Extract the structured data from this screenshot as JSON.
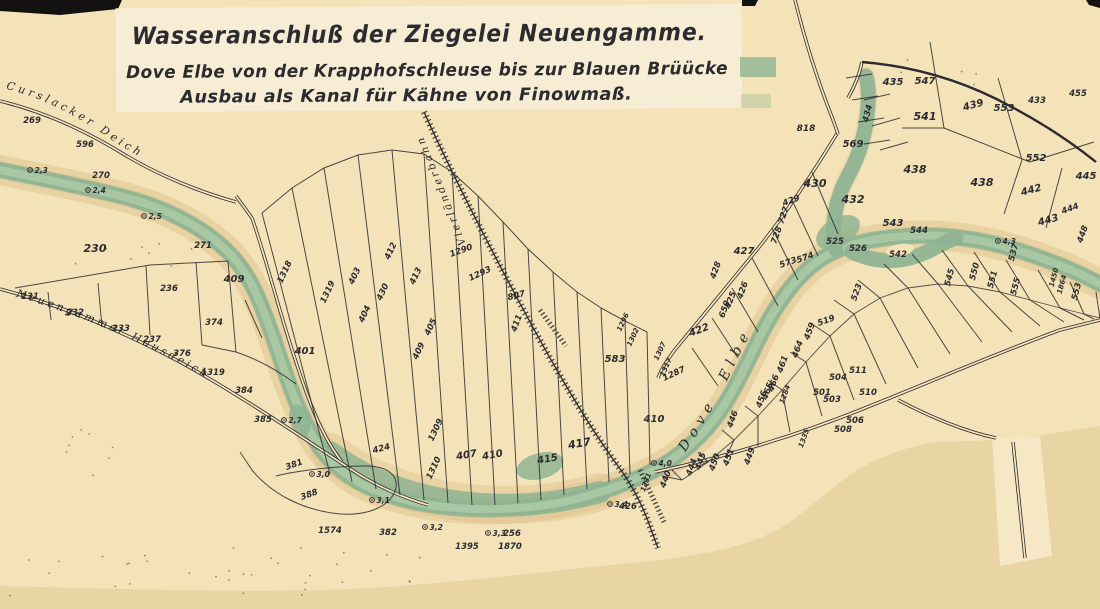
{
  "title_block": {
    "line1": "Wasseranschluß der Ziegelei Neuengamme.",
    "line2": "Dove Elbe von der Krapphofschleuse bis zur Blauen Brüücke",
    "line3": "Ausbau als Kanal für Kähne von Finowmaß."
  },
  "map": {
    "place_labels": {
      "curslacker": "Curslacker Deich",
      "hausdeich": "Neuengammer Hausdeich",
      "bahn": "Vierländerbahn",
      "dove": "Dove Elbe"
    },
    "colors": {
      "ink": "#2b2b30",
      "paper": "#f4e3b8",
      "paper_light": "#f7ecd4",
      "backing": "#e9d4a4",
      "water": "#8fb492",
      "water_light": "#abc9a4",
      "water_edge": "#6f9c7e",
      "bank": "#ddc28c",
      "wedge": "#e4cd9c",
      "blue_label": "#3f5680",
      "black_edge": "#141210"
    },
    "parcel_numbers": [
      {
        "t": "269",
        "x": 32,
        "y": 123
      },
      {
        "t": "596",
        "x": 85,
        "y": 147
      },
      {
        "t": "270",
        "x": 101,
        "y": 178
      },
      {
        "t": "230",
        "x": 95,
        "y": 252,
        "s": 11
      },
      {
        "t": "231",
        "x": 30,
        "y": 299
      },
      {
        "t": "232",
        "x": 75,
        "y": 315
      },
      {
        "t": "233",
        "x": 121,
        "y": 331
      },
      {
        "t": "236",
        "x": 169,
        "y": 291
      },
      {
        "t": "237",
        "x": 152,
        "y": 342
      },
      {
        "t": "271",
        "x": 203,
        "y": 248
      },
      {
        "t": "409",
        "x": 234,
        "y": 282,
        "s": 10
      },
      {
        "t": "374",
        "x": 214,
        "y": 325
      },
      {
        "t": "376",
        "x": 182,
        "y": 356
      },
      {
        "t": "1319",
        "x": 213,
        "y": 375
      },
      {
        "t": "384",
        "x": 244,
        "y": 393
      },
      {
        "t": "385",
        "x": 263,
        "y": 422
      },
      {
        "t": "381",
        "x": 295,
        "y": 467,
        "r": -20
      },
      {
        "t": "388",
        "x": 310,
        "y": 497,
        "r": -20
      },
      {
        "t": "1574",
        "x": 330,
        "y": 533
      },
      {
        "t": "382",
        "x": 388,
        "y": 535
      },
      {
        "t": "424",
        "x": 382,
        "y": 451,
        "r": -15
      },
      {
        "t": "401",
        "x": 305,
        "y": 354,
        "s": 10
      },
      {
        "t": "1318",
        "x": 287,
        "y": 273,
        "r": -65
      },
      {
        "t": "1319",
        "x": 330,
        "y": 293,
        "r": -65
      },
      {
        "t": "403",
        "x": 357,
        "y": 277,
        "r": -65
      },
      {
        "t": "430",
        "x": 385,
        "y": 293,
        "r": -65
      },
      {
        "t": "404",
        "x": 367,
        "y": 315,
        "r": -65
      },
      {
        "t": "412",
        "x": 393,
        "y": 252,
        "r": -65
      },
      {
        "t": "413",
        "x": 418,
        "y": 277,
        "r": -65
      },
      {
        "t": "405",
        "x": 433,
        "y": 328,
        "r": -65
      },
      {
        "t": "409",
        "x": 421,
        "y": 352,
        "r": -65
      },
      {
        "t": "1309",
        "x": 438,
        "y": 431,
        "r": -65
      },
      {
        "t": "1310",
        "x": 436,
        "y": 469,
        "r": -65
      },
      {
        "t": "407",
        "x": 467,
        "y": 458,
        "s": 10,
        "r": -10
      },
      {
        "t": "410",
        "x": 493,
        "y": 458,
        "s": 10,
        "r": -10
      },
      {
        "t": "415",
        "x": 548,
        "y": 462,
        "s": 10,
        "r": -10
      },
      {
        "t": "417",
        "x": 580,
        "y": 447,
        "s": 11,
        "r": -10
      },
      {
        "t": "1290",
        "x": 462,
        "y": 253,
        "r": -20
      },
      {
        "t": "1293",
        "x": 481,
        "y": 276,
        "r": -25
      },
      {
        "t": "807",
        "x": 517,
        "y": 298,
        "r": -15
      },
      {
        "t": "411",
        "x": 519,
        "y": 324,
        "r": -70
      },
      {
        "t": "583",
        "x": 615,
        "y": 362,
        "s": 10
      },
      {
        "t": "1296",
        "x": 625,
        "y": 323,
        "r": -65,
        "s": 7
      },
      {
        "t": "1302",
        "x": 635,
        "y": 338,
        "r": -65,
        "s": 7
      },
      {
        "t": "1307",
        "x": 662,
        "y": 352,
        "r": -65,
        "s": 7
      },
      {
        "t": "1317",
        "x": 668,
        "y": 368,
        "r": -65,
        "s": 7
      },
      {
        "t": "410",
        "x": 654,
        "y": 422,
        "s": 10
      },
      {
        "t": "426",
        "x": 628,
        "y": 509
      },
      {
        "t": "256",
        "x": 512,
        "y": 536
      },
      {
        "t": "1395",
        "x": 467,
        "y": 549
      },
      {
        "t": "1870",
        "x": 510,
        "y": 549
      },
      {
        "t": "818",
        "x": 806,
        "y": 131,
        "s": 9
      },
      {
        "t": "435",
        "x": 893,
        "y": 85,
        "s": 10
      },
      {
        "t": "547",
        "x": 925,
        "y": 84,
        "s": 10
      },
      {
        "t": "541",
        "x": 925,
        "y": 120,
        "s": 11
      },
      {
        "t": "434",
        "x": 870,
        "y": 114,
        "r": -75
      },
      {
        "t": "569",
        "x": 853,
        "y": 147,
        "s": 10
      },
      {
        "t": "430",
        "x": 815,
        "y": 187,
        "s": 11
      },
      {
        "t": "429",
        "x": 792,
        "y": 203,
        "r": -20
      },
      {
        "t": "727",
        "x": 786,
        "y": 216,
        "r": -70
      },
      {
        "t": "728",
        "x": 779,
        "y": 236,
        "r": -70
      },
      {
        "t": "428",
        "x": 718,
        "y": 271,
        "r": -70
      },
      {
        "t": "427",
        "x": 744,
        "y": 254,
        "s": 10
      },
      {
        "t": "432",
        "x": 853,
        "y": 203,
        "s": 11
      },
      {
        "t": "438",
        "x": 915,
        "y": 173,
        "s": 11
      },
      {
        "t": "543",
        "x": 893,
        "y": 226,
        "s": 10
      },
      {
        "t": "544",
        "x": 919,
        "y": 233
      },
      {
        "t": "525",
        "x": 835,
        "y": 244
      },
      {
        "t": "526",
        "x": 858,
        "y": 251
      },
      {
        "t": "573",
        "x": 789,
        "y": 265,
        "r": -20
      },
      {
        "t": "574",
        "x": 806,
        "y": 260,
        "r": -20
      },
      {
        "t": "542",
        "x": 898,
        "y": 257
      },
      {
        "t": "426",
        "x": 745,
        "y": 291,
        "r": -70
      },
      {
        "t": "425",
        "x": 733,
        "y": 301,
        "r": -70
      },
      {
        "t": "650",
        "x": 727,
        "y": 310,
        "r": -70
      },
      {
        "t": "422",
        "x": 700,
        "y": 333,
        "r": -20,
        "s": 10
      },
      {
        "t": "1287",
        "x": 675,
        "y": 376,
        "r": -25
      },
      {
        "t": "459",
        "x": 812,
        "y": 332,
        "r": -70
      },
      {
        "t": "464",
        "x": 800,
        "y": 350,
        "r": -70
      },
      {
        "t": "461",
        "x": 785,
        "y": 365,
        "r": -70
      },
      {
        "t": "466",
        "x": 776,
        "y": 384,
        "r": -70
      },
      {
        "t": "465",
        "x": 770,
        "y": 392,
        "r": -70
      },
      {
        "t": "456",
        "x": 764,
        "y": 400,
        "r": -70
      },
      {
        "t": "1284",
        "x": 787,
        "y": 395,
        "r": -70,
        "s": 7
      },
      {
        "t": "1335",
        "x": 806,
        "y": 439,
        "r": -70,
        "s": 7
      },
      {
        "t": "449",
        "x": 752,
        "y": 457,
        "r": -70
      },
      {
        "t": "451",
        "x": 731,
        "y": 458,
        "r": -70
      },
      {
        "t": "450",
        "x": 717,
        "y": 463,
        "r": -70
      },
      {
        "t": "445",
        "x": 703,
        "y": 462,
        "r": -70
      },
      {
        "t": "444",
        "x": 694,
        "y": 468,
        "r": -70
      },
      {
        "t": "440",
        "x": 668,
        "y": 480,
        "r": -70
      },
      {
        "t": "1331",
        "x": 648,
        "y": 483,
        "r": -70,
        "s": 7
      },
      {
        "t": "446",
        "x": 735,
        "y": 420,
        "r": -70
      },
      {
        "t": "501",
        "x": 822,
        "y": 395
      },
      {
        "t": "503",
        "x": 832,
        "y": 402
      },
      {
        "t": "504",
        "x": 838,
        "y": 380
      },
      {
        "t": "506",
        "x": 855,
        "y": 423
      },
      {
        "t": "508",
        "x": 843,
        "y": 432
      },
      {
        "t": "510",
        "x": 868,
        "y": 395
      },
      {
        "t": "511",
        "x": 858,
        "y": 373
      },
      {
        "t": "519",
        "x": 827,
        "y": 323,
        "r": -20
      },
      {
        "t": "523",
        "x": 859,
        "y": 293,
        "r": -70
      },
      {
        "t": "439",
        "x": 974,
        "y": 108,
        "s": 10,
        "r": -15
      },
      {
        "t": "553",
        "x": 1004,
        "y": 111,
        "s": 10
      },
      {
        "t": "552",
        "x": 1036,
        "y": 161,
        "s": 10
      },
      {
        "t": "445",
        "x": 1086,
        "y": 179,
        "s": 10
      },
      {
        "t": "438",
        "x": 982,
        "y": 186,
        "s": 11
      },
      {
        "t": "442",
        "x": 1032,
        "y": 193,
        "s": 10,
        "r": -15
      },
      {
        "t": "444",
        "x": 1071,
        "y": 211,
        "r": -20
      },
      {
        "t": "443",
        "x": 1049,
        "y": 223,
        "s": 10,
        "r": -15
      },
      {
        "t": "448",
        "x": 1085,
        "y": 235,
        "r": -70
      },
      {
        "t": "537",
        "x": 1016,
        "y": 253,
        "r": -75
      },
      {
        "t": "545",
        "x": 952,
        "y": 278,
        "r": -75
      },
      {
        "t": "550",
        "x": 977,
        "y": 272,
        "r": -75
      },
      {
        "t": "551",
        "x": 995,
        "y": 280,
        "r": -75
      },
      {
        "t": "555",
        "x": 1018,
        "y": 287,
        "r": -75
      },
      {
        "t": "1450",
        "x": 1056,
        "y": 278,
        "r": -75,
        "s": 7
      },
      {
        "t": "1864",
        "x": 1064,
        "y": 285,
        "r": -75,
        "s": 7
      },
      {
        "t": "553",
        "x": 1079,
        "y": 292,
        "r": -75
      },
      {
        "t": "433",
        "x": 1037,
        "y": 103
      },
      {
        "t": "455",
        "x": 1078,
        "y": 96
      }
    ],
    "depth_soundings": [
      {
        "v": "2,3",
        "x": 30,
        "y": 170
      },
      {
        "v": "2,4",
        "x": 88,
        "y": 190
      },
      {
        "v": "2,5",
        "x": 144,
        "y": 216
      },
      {
        "v": "2,7",
        "x": 284,
        "y": 420
      },
      {
        "v": "3,0",
        "x": 312,
        "y": 474
      },
      {
        "v": "3,1",
        "x": 372,
        "y": 500
      },
      {
        "v": "3,2",
        "x": 425,
        "y": 527
      },
      {
        "v": "3,3",
        "x": 488,
        "y": 533
      },
      {
        "v": "3,4",
        "x": 610,
        "y": 504
      },
      {
        "v": "4,0",
        "x": 654,
        "y": 463
      },
      {
        "v": "4,3",
        "x": 998,
        "y": 241
      }
    ]
  }
}
